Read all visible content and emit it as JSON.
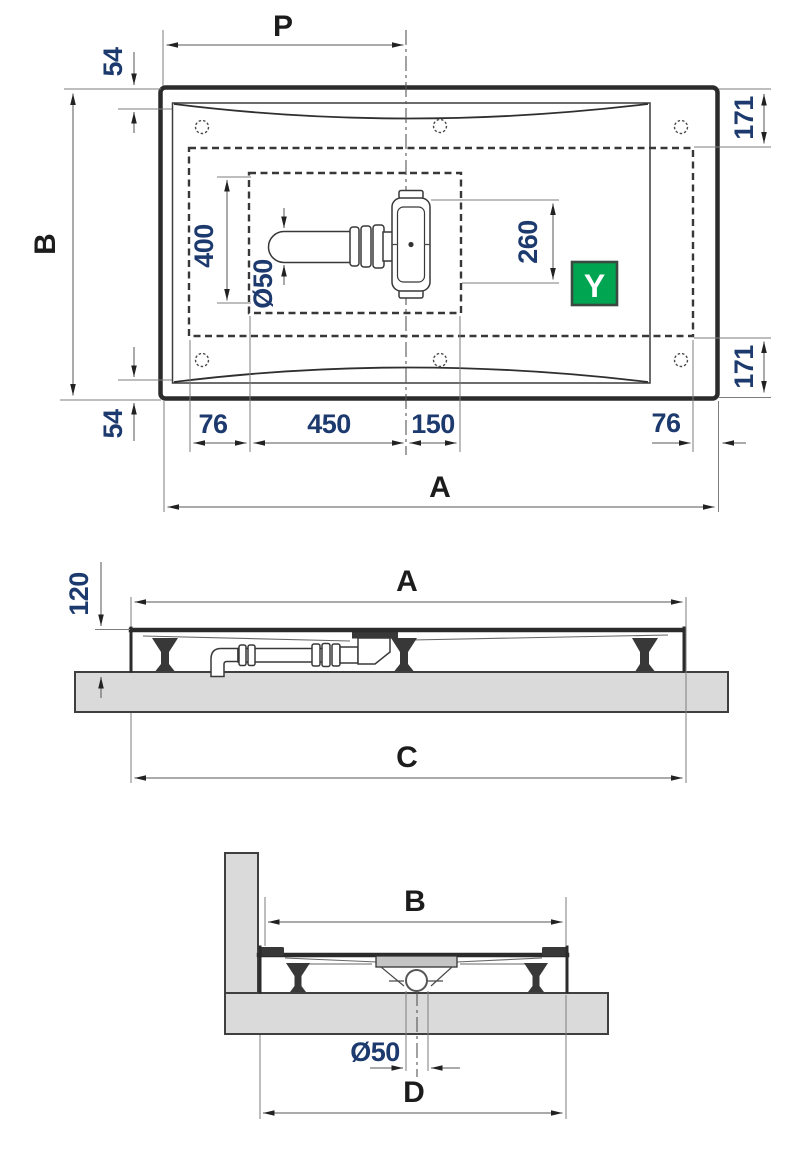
{
  "colors": {
    "zone_fill": "#cde9d2",
    "badge_fill": "#00a551",
    "slab_fill": "#dadada",
    "flange_fill": "#c4c4c4"
  },
  "plan_view": {
    "dim_p": "P",
    "dim_b": "B",
    "dim_a": "A",
    "dim_54_top": "54",
    "dim_54_bottom": "54",
    "dim_171_top": "171",
    "dim_171_bottom": "171",
    "dim_400": "400",
    "dim_260": "260",
    "dim_diameter": "Ø50",
    "dim_76_left": "76",
    "dim_450": "450",
    "dim_150": "150",
    "dim_76_right": "76",
    "badge_label": "Y"
  },
  "side_view": {
    "dim_a": "A",
    "dim_120": "120",
    "dim_c": "C"
  },
  "front_view": {
    "dim_b": "B",
    "dim_diameter": "Ø50",
    "dim_d": "D"
  }
}
